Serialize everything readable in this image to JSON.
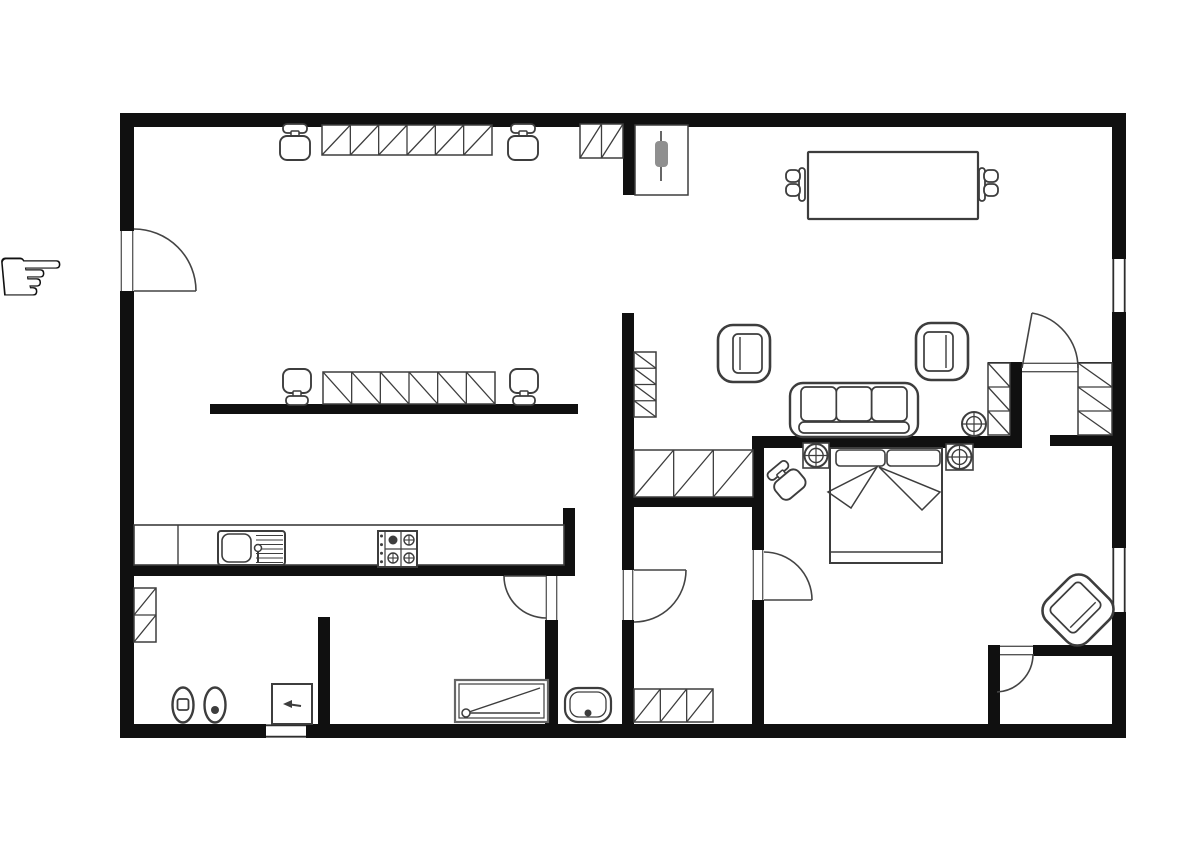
{
  "canvas": {
    "w": 1200,
    "h": 847,
    "bg": "#ffffff"
  },
  "colors": {
    "wall": "#101010",
    "stroke": "#3d3d3d",
    "frame": "#2e2e2e",
    "thin": "#555555",
    "gray_fill": "#8f8f8f"
  },
  "decor": {
    "pointer_hand": {
      "glyph": "☞",
      "x": -6,
      "y": 304,
      "size": 82
    }
  },
  "plan": {
    "walls": [
      {
        "name": "outer-wall-top",
        "x": 120,
        "y": 113,
        "w": 1006,
        "h": 14
      },
      {
        "name": "outer-wall-left-upper",
        "x": 120,
        "y": 113,
        "w": 14,
        "h": 118
      },
      {
        "name": "outer-wall-left-lower",
        "x": 120,
        "y": 291,
        "w": 14,
        "h": 447
      },
      {
        "name": "outer-wall-right-1",
        "x": 1112,
        "y": 113,
        "w": 14,
        "h": 146
      },
      {
        "name": "outer-wall-right-2",
        "x": 1112,
        "y": 312,
        "w": 14,
        "h": 236
      },
      {
        "name": "outer-wall-right-3",
        "x": 1112,
        "y": 612,
        "w": 14,
        "h": 126
      },
      {
        "name": "outer-wall-bottom-left",
        "x": 120,
        "y": 724,
        "w": 146,
        "h": 14
      },
      {
        "name": "outer-wall-bottom-right",
        "x": 306,
        "y": 724,
        "w": 820,
        "h": 14
      },
      {
        "name": "wall-entry-stub",
        "x": 623,
        "y": 113,
        "w": 12,
        "h": 82
      },
      {
        "name": "wall-hall-main",
        "x": 622,
        "y": 313,
        "w": 12,
        "h": 257
      },
      {
        "name": "wall-hall-lower",
        "x": 622,
        "y": 620,
        "w": 12,
        "h": 104
      },
      {
        "name": "wall-office-partition",
        "x": 210,
        "y": 404,
        "w": 368,
        "h": 10
      },
      {
        "name": "wall-kitchen-counter",
        "x": 130,
        "y": 565,
        "w": 445,
        "h": 11
      },
      {
        "name": "wall-counter-stub",
        "x": 563,
        "y": 508,
        "w": 12,
        "h": 57
      },
      {
        "name": "wall-bath-door",
        "x": 545,
        "y": 620,
        "w": 13,
        "h": 104
      },
      {
        "name": "wall-toilet",
        "x": 318,
        "y": 617,
        "w": 12,
        "h": 107
      },
      {
        "name": "wall-bedroom-left-upper",
        "x": 752,
        "y": 438,
        "w": 12,
        "h": 112
      },
      {
        "name": "wall-bedroom-left-lower",
        "x": 752,
        "y": 600,
        "w": 12,
        "h": 124
      },
      {
        "name": "wall-bedroom-top",
        "x": 752,
        "y": 436,
        "w": 270,
        "h": 12
      },
      {
        "name": "wall-closet-inner",
        "x": 1010,
        "y": 363,
        "w": 12,
        "h": 85
      },
      {
        "name": "wall-closet-top-left",
        "x": 988,
        "y": 362,
        "w": 34,
        "h": 11
      },
      {
        "name": "wall-closet-top-right",
        "x": 1078,
        "y": 362,
        "w": 34,
        "h": 11
      },
      {
        "name": "wall-closet-bottom",
        "x": 1050,
        "y": 435,
        "w": 62,
        "h": 11
      },
      {
        "name": "wall-corridor",
        "x": 634,
        "y": 497,
        "w": 119,
        "h": 10
      },
      {
        "name": "wall-storage-left",
        "x": 988,
        "y": 645,
        "w": 12,
        "h": 79
      },
      {
        "name": "wall-storage-top",
        "x": 1033,
        "y": 645,
        "w": 79,
        "h": 11
      }
    ],
    "windows": [
      {
        "name": "window-right-upper",
        "x": 1112,
        "y": 259,
        "w": 14,
        "h": 53,
        "dir": "v"
      },
      {
        "name": "window-right-lower",
        "x": 1112,
        "y": 548,
        "w": 14,
        "h": 64,
        "dir": "v"
      },
      {
        "name": "window-bottom",
        "x": 266,
        "y": 724,
        "w": 40,
        "h": 14,
        "dir": "h"
      }
    ],
    "door_openings": [
      {
        "name": "opening-entry",
        "x": 120,
        "y": 231,
        "w": 14,
        "h": 60,
        "dir": "v"
      },
      {
        "name": "opening-hall",
        "x": 622,
        "y": 570,
        "w": 12,
        "h": 50,
        "dir": "v"
      },
      {
        "name": "opening-bath",
        "x": 545,
        "y": 576,
        "w": 13,
        "h": 44,
        "dir": "v"
      },
      {
        "name": "opening-bedroom",
        "x": 752,
        "y": 550,
        "w": 12,
        "h": 50,
        "dir": "v"
      },
      {
        "name": "opening-closet",
        "x": 1022,
        "y": 362,
        "w": 56,
        "h": 11,
        "dir": "h"
      },
      {
        "name": "opening-storage",
        "x": 1000,
        "y": 645,
        "w": 33,
        "h": 11,
        "dir": "h"
      }
    ],
    "doors": [
      {
        "name": "door-entry",
        "leaf": [
          134,
          291,
          196,
          291
        ],
        "arc": "M196,291 A62,62 0 0 0 134,229"
      },
      {
        "name": "door-hall",
        "leaf": [
          634,
          570,
          686,
          570
        ],
        "arc": "M686,570 A52,52 0 0 1 634,622"
      },
      {
        "name": "door-bath",
        "leaf": [
          546,
          576,
          504,
          576
        ],
        "arc": "M504,576 A42,42 0 0 0 546,618"
      },
      {
        "name": "door-bedroom",
        "leaf": [
          764,
          600,
          812,
          600
        ],
        "arc": "M812,600 A48,48 0 0 0 764,552"
      },
      {
        "name": "door-closet",
        "leaf": [
          1022,
          368,
          1032,
          313
        ],
        "arc": "M1032,313 A56,56 0 0 1 1078,368"
      },
      {
        "name": "door-storage",
        "leaf": null,
        "arc": "M997,692 A38,38 0 0 0 1033,654"
      }
    ],
    "cabinets": [
      {
        "name": "desk-top",
        "x": 322,
        "y": 125,
        "w": 170,
        "h": 30,
        "cells": 6,
        "dir": "h",
        "slash": "/"
      },
      {
        "name": "cabinet-entry-small",
        "x": 580,
        "y": 124,
        "w": 43,
        "h": 34,
        "cells": 2,
        "dir": "h",
        "slash": "/"
      },
      {
        "name": "desk-middle",
        "x": 323,
        "y": 372,
        "w": 172,
        "h": 32,
        "cells": 6,
        "dir": "h",
        "slash": "\\"
      },
      {
        "name": "shelf-hall",
        "x": 634,
        "y": 352,
        "w": 22,
        "h": 65,
        "cells": 4,
        "dir": "v",
        "slash": "\\"
      },
      {
        "name": "cabinet-corridor",
        "x": 634,
        "y": 450,
        "w": 119,
        "h": 47,
        "cells": 3,
        "dir": "h",
        "slash": "/"
      },
      {
        "name": "cabinet-hall-bottom",
        "x": 634,
        "y": 689,
        "w": 79,
        "h": 33,
        "cells": 3,
        "dir": "h",
        "slash": "/"
      },
      {
        "name": "closet-kitchen-left",
        "x": 134,
        "y": 588,
        "w": 22,
        "h": 54,
        "cells": 2,
        "dir": "v",
        "slash": "/"
      },
      {
        "name": "wardrobe-left",
        "x": 988,
        "y": 363,
        "w": 22,
        "h": 72,
        "cells": 3,
        "dir": "v",
        "slash": "\\"
      },
      {
        "name": "wardrobe-right",
        "x": 1078,
        "y": 363,
        "w": 34,
        "h": 72,
        "cells": 3,
        "dir": "v",
        "slash": "\\"
      }
    ],
    "furniture": [
      {
        "type": "office-chair",
        "name": "office-chair-1",
        "x": 280,
        "y": 124,
        "w": 30,
        "h": 36,
        "facing": "down",
        "rot": 0
      },
      {
        "type": "office-chair",
        "name": "office-chair-2",
        "x": 508,
        "y": 124,
        "w": 30,
        "h": 36,
        "facing": "down",
        "rot": 0
      },
      {
        "type": "office-chair",
        "name": "office-chair-3",
        "x": 283,
        "y": 369,
        "w": 28,
        "h": 36,
        "facing": "up",
        "rot": 0
      },
      {
        "type": "office-chair",
        "name": "office-chair-4",
        "x": 510,
        "y": 369,
        "w": 28,
        "h": 36,
        "facing": "up",
        "rot": 0
      },
      {
        "type": "office-chair",
        "name": "bedroom-stool",
        "x": 771,
        "y": 463,
        "w": 30,
        "h": 34,
        "facing": "down",
        "rot": -40
      },
      {
        "type": "closet-rack",
        "name": "entry-closet",
        "x": 635,
        "y": 125,
        "w": 53,
        "h": 70
      },
      {
        "type": "dining-table",
        "name": "dining-table",
        "x": 808,
        "y": 152,
        "w": 170,
        "h": 67
      },
      {
        "type": "dining-chair",
        "name": "dining-chair-left",
        "x": 786,
        "y": 167,
        "side": "left"
      },
      {
        "type": "dining-chair",
        "name": "dining-chair-right",
        "x": 979,
        "y": 167,
        "side": "right"
      },
      {
        "type": "armchair",
        "name": "armchair-left",
        "x": 718,
        "y": 325,
        "w": 52,
        "h": 57,
        "facing": "right",
        "rot": 0
      },
      {
        "type": "armchair",
        "name": "armchair-right",
        "x": 916,
        "y": 323,
        "w": 52,
        "h": 57,
        "facing": "left",
        "rot": 0
      },
      {
        "type": "armchair",
        "name": "armchair-corner",
        "x": 1049,
        "y": 580,
        "w": 58,
        "h": 60,
        "facing": "left",
        "rot": 45
      },
      {
        "type": "sofa",
        "name": "sofa",
        "x": 790,
        "y": 383,
        "w": 128,
        "h": 54
      },
      {
        "type": "bed",
        "name": "double-bed",
        "x": 830,
        "y": 448,
        "w": 112,
        "h": 115
      },
      {
        "type": "nightstand",
        "name": "nightstand-left",
        "x": 803,
        "y": 443,
        "w": 26,
        "h": 25
      },
      {
        "type": "nightstand",
        "name": "nightstand-right",
        "x": 946,
        "y": 444,
        "w": 27,
        "h": 26
      },
      {
        "type": "plant",
        "name": "plant-corner",
        "cx": 974,
        "cy": 424,
        "r": 12
      },
      {
        "type": "kitchen-counter",
        "name": "kitchen-counter",
        "x": 134,
        "y": 525,
        "w": 430,
        "h": 40,
        "divider_x": 178
      },
      {
        "type": "kitchen-sink",
        "name": "kitchen-sink",
        "x": 218,
        "y": 531
      },
      {
        "type": "stove",
        "name": "stove",
        "x": 378,
        "y": 531
      },
      {
        "type": "toilet",
        "name": "bidet",
        "cx": 183,
        "cy": 705,
        "inner": "square"
      },
      {
        "type": "toilet",
        "name": "toilet",
        "cx": 215,
        "cy": 705,
        "inner": "dot"
      },
      {
        "type": "utility-box",
        "name": "washing-machine",
        "x": 272,
        "y": 684,
        "w": 40,
        "h": 40
      },
      {
        "type": "shower-tray",
        "name": "shower-tray",
        "x": 455,
        "y": 680,
        "w": 93,
        "h": 42
      },
      {
        "type": "washbasin",
        "name": "washbasin",
        "x": 565,
        "y": 688,
        "w": 46,
        "h": 34
      }
    ]
  }
}
